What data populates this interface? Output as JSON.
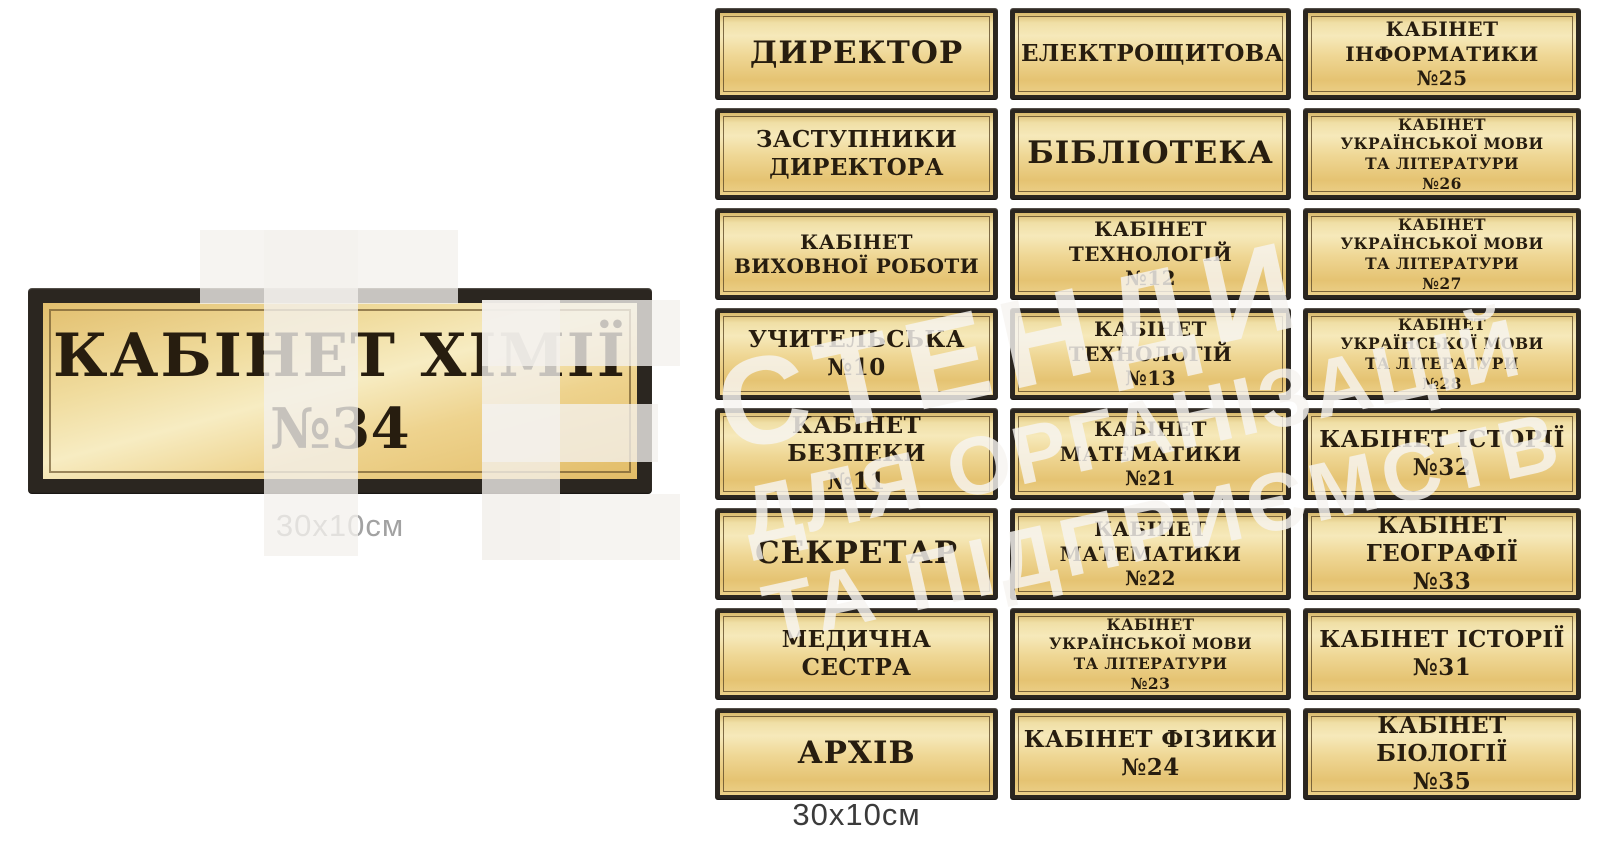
{
  "featured_sign": {
    "line1": "КАБІНЕТ ХІМІЇ",
    "line2": "№34",
    "size_label": "30x10см"
  },
  "grid": {
    "size_label": "30x10см",
    "signs": [
      {
        "size": "xl",
        "lines": [
          "ДИРЕКТОР"
        ]
      },
      {
        "size": "lg",
        "lines": [
          "ЕЛЕКТРОЩИТОВА"
        ]
      },
      {
        "size": "md",
        "lines": [
          "КАБІНЕТ",
          "ІНФОРМАТИКИ",
          "№25"
        ]
      },
      {
        "size": "lg",
        "lines": [
          "ЗАСТУПНИКИ",
          "ДИРЕКТОРА"
        ]
      },
      {
        "size": "xl",
        "lines": [
          "БІБЛІОТЕКА"
        ]
      },
      {
        "size": "sm",
        "lines": [
          "КАБІНЕТ",
          "УКРАЇНСЬКОЇ МОВИ",
          "ТА ЛІТЕРАТУРИ",
          "№26"
        ]
      },
      {
        "size": "md",
        "lines": [
          "КАБІНЕТ",
          "ВИХОВНОЇ РОБОТИ"
        ]
      },
      {
        "size": "md",
        "lines": [
          "КАБІНЕТ ТЕХНОЛОГІЙ",
          "№12"
        ]
      },
      {
        "size": "sm",
        "lines": [
          "КАБІНЕТ",
          "УКРАЇНСЬКОЇ МОВИ",
          "ТА ЛІТЕРАТУРИ",
          "№27"
        ]
      },
      {
        "size": "lg",
        "lines": [
          "УЧИТЕЛЬСЬКА",
          "№10"
        ]
      },
      {
        "size": "md",
        "lines": [
          "КАБІНЕТ ТЕХНОЛОГІЙ",
          "№13"
        ]
      },
      {
        "size": "sm",
        "lines": [
          "КАБІНЕТ",
          "УКРАЇНСЬКОЇ МОВИ",
          "ТА ЛІТЕРАТУРИ",
          "№28"
        ]
      },
      {
        "size": "lg",
        "lines": [
          "КАБІНЕТ БЕЗПЕКИ",
          "№11"
        ]
      },
      {
        "size": "md",
        "lines": [
          "КАБІНЕТ МАТЕМАТИКИ",
          "№21"
        ]
      },
      {
        "size": "lg",
        "lines": [
          "КАБІНЕТ ІСТОРІЇ",
          "№32"
        ]
      },
      {
        "size": "xl",
        "lines": [
          "СЕКРЕТАР"
        ]
      },
      {
        "size": "md",
        "lines": [
          "КАБІНЕТ МАТЕМАТИКИ",
          "№22"
        ]
      },
      {
        "size": "lg",
        "lines": [
          "КАБІНЕТ ГЕОГРАФІЇ",
          "№33"
        ]
      },
      {
        "size": "lg",
        "lines": [
          "МЕДИЧНА СЕСТРА"
        ]
      },
      {
        "size": "sm",
        "lines": [
          "КАБІНЕТ",
          "УКРАЇНСЬКОЇ МОВИ",
          "ТА ЛІТЕРАТУРИ",
          "№23"
        ]
      },
      {
        "size": "lg",
        "lines": [
          "КАБІНЕТ ІСТОРІЇ",
          "№31"
        ]
      },
      {
        "size": "xl",
        "lines": [
          "АРХІВ"
        ]
      },
      {
        "size": "lg",
        "lines": [
          "КАБІНЕТ ФІЗИКИ",
          "№24"
        ]
      },
      {
        "size": "lg",
        "lines": [
          "КАБІНЕТ БІОЛОГІЇ",
          "№35"
        ]
      }
    ]
  },
  "watermark": {
    "line1": "СТЕНДИ",
    "line2": "ДЛЯ ОРГАНІЗАЦІЙ",
    "line3": "ТА ПІДПРИЄМСТВ"
  },
  "colors": {
    "plate_gold_light": "#f6e9ba",
    "plate_gold_dark": "#e5c372",
    "frame_black": "#2b2620",
    "sign_text": "#271d0f",
    "size_label_left": "#a2a2a2",
    "size_label_grid": "#3b3b3b",
    "watermark": "#f3f1ed",
    "background": "#ffffff"
  }
}
